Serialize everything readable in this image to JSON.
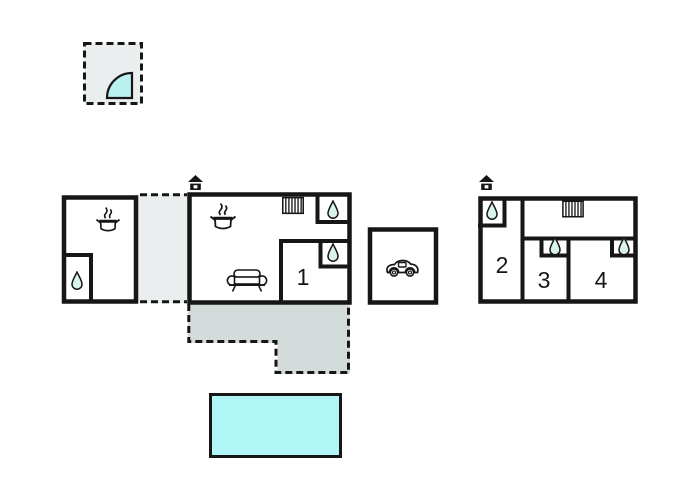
{
  "palette": {
    "wall": "#161616",
    "paper": "#ffffff",
    "room_fill": "#ffffff",
    "dashed_area_fill": "#ebeeee",
    "terrace_fill": "#d4dcdb",
    "pool_fill": "#b0f6f6",
    "water_icon_fill": "#d8f2ee",
    "door_arc_fill": "#b9f1f1"
  },
  "rooms": {
    "room1": {
      "label": "1"
    },
    "room2": {
      "label": "2"
    },
    "room3": {
      "label": "3"
    },
    "room4": {
      "label": "4"
    }
  },
  "icons": {
    "water_drop": "wet-room water drop",
    "cooking_pot": "kitchen cooking pot with steam",
    "stairs": "staircase",
    "house": "house entrance marker",
    "sofa": "living-room sofa",
    "car": "garage car",
    "door_arc": "quarter-circle door swing"
  }
}
